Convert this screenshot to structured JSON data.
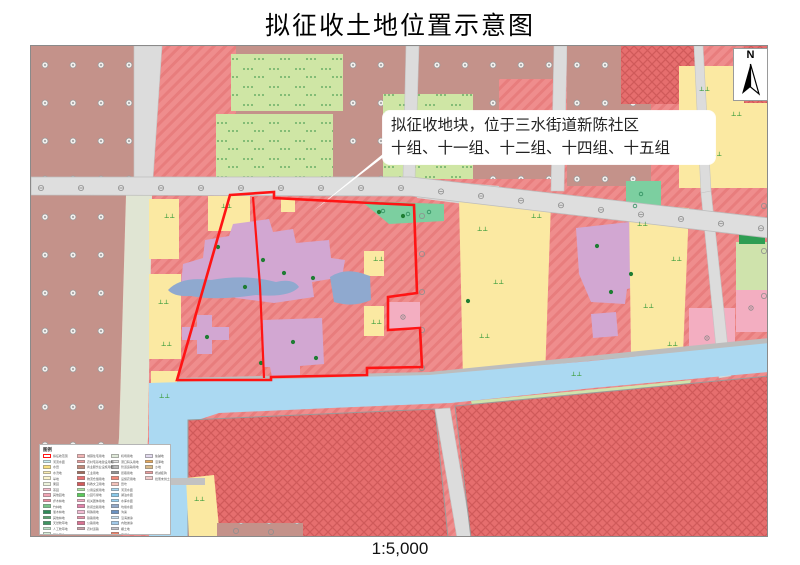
{
  "title": "拟征收土地位置示意图",
  "scale_label": "1:5,000",
  "north_label": "N",
  "annotation": {
    "line1": "拟征收地块，位于三水街道新陈社区",
    "line2": "十组、十一组、十二组、十四组、十五组"
  },
  "colors": {
    "boundary_red": "#ff1414",
    "hatch_base": "#ef8d8d",
    "hatch_line": "#e87d7d",
    "cross_base": "#e66e6e",
    "cross_line": "#d05a5a",
    "brown_parcel": "#c4928a",
    "paddy_green": "#cfe6a5",
    "yellow_parcel": "#fbe9a2",
    "lavender_parcel": "#d2a7d2",
    "pond_blue": "#8fa9cf",
    "canal_blue": "#abd9f2",
    "road_gray": "#dedede",
    "teal_parcel": "#7ccfa0",
    "pink_parcel": "#f3aec1",
    "pale_green": "#cfe3ac"
  },
  "legend": {
    "title": "图例",
    "columns": [
      [
        {
          "label": "拟征收范围",
          "color": "#ffffff",
          "type": "outline"
        },
        {
          "label": "河流水面",
          "color": "#c8eef0"
        },
        {
          "label": "水田",
          "color": "#f8df7e"
        },
        {
          "label": "水浇地",
          "color": "#fbedb0"
        },
        {
          "label": "旱地",
          "color": "#fdf5cd"
        },
        {
          "label": "果园",
          "color": "#eef3dc"
        },
        {
          "label": "茶园",
          "color": "#f6bcca"
        },
        {
          "label": "其他园地",
          "color": "#f2a6b6"
        },
        {
          "label": "乔木林地",
          "color": "#ec8c9e"
        },
        {
          "label": "竹林地",
          "color": "#78c488"
        },
        {
          "label": "灌木林地",
          "color": "#2e8b57"
        },
        {
          "label": "其他林地",
          "color": "#57a56d"
        },
        {
          "label": "天然牧草地",
          "color": "#3d9560"
        },
        {
          "label": "人工牧草地",
          "color": "#bce2c6"
        },
        {
          "label": "其他草地",
          "color": "#d6eed6"
        }
      ],
      [
        {
          "label": "城镇住宅用地",
          "color": "#f2b4b4"
        },
        {
          "label": "农村宅基地建设用地",
          "color": "#ea9c9c"
        },
        {
          "label": "商业服务业设施用地",
          "color": "#c28a7a"
        },
        {
          "label": "工业用地",
          "color": "#a26a5a"
        },
        {
          "label": "物流仓储用地",
          "color": "#ea7272"
        },
        {
          "label": "科教文卫用地",
          "color": "#d25a5a"
        },
        {
          "label": "公用设施用地",
          "color": "#aae2a2"
        },
        {
          "label": "公园与绿地",
          "color": "#5aca5a"
        },
        {
          "label": "机关团体用地",
          "color": "#f2aac2"
        },
        {
          "label": "新闻出版用地",
          "color": "#e282aa"
        },
        {
          "label": "特殊用地",
          "color": "#f2bad2"
        },
        {
          "label": "铁路用地",
          "color": "#ea92aa"
        },
        {
          "label": "公路用地",
          "color": "#da7292"
        },
        {
          "label": "农村道路",
          "color": "#caa2aa"
        }
      ],
      [
        {
          "label": "机场用地",
          "color": "#dfe9d9"
        },
        {
          "label": "港口码头用地",
          "color": "#e2e2e2"
        },
        {
          "label": "管道运输用地",
          "color": "#bababa"
        },
        {
          "label": "街巷用地",
          "color": "#929292"
        },
        {
          "label": "设施农用地",
          "color": "#f28a7a"
        },
        {
          "label": "田坎",
          "color": "#f2c2ba"
        },
        {
          "label": "河流水面",
          "color": "#aad8f2"
        },
        {
          "label": "湖泊水面",
          "color": "#8acaea"
        },
        {
          "label": "水库水面",
          "color": "#9ad2f2"
        },
        {
          "label": "坑塘水面",
          "color": "#92aaca"
        },
        {
          "label": "沟渠",
          "color": "#6a92c2"
        },
        {
          "label": "沿海滩涂",
          "color": "#cae2f2"
        },
        {
          "label": "内陆滩涂",
          "color": "#a2caea"
        },
        {
          "label": "裸土地",
          "color": "#c2c2ca"
        },
        {
          "label": "空闲地",
          "color": "#f28268"
        }
      ],
      [
        {
          "label": "盐碱地",
          "color": "#e2daee"
        },
        {
          "label": "沼泽地",
          "color": "#eaaa5a"
        },
        {
          "label": "沙地",
          "color": "#daba8a"
        },
        {
          "label": "增减挂钩",
          "color": "#eb9d9d"
        },
        {
          "label": "批而未供土地",
          "color": "#f2caca"
        }
      ]
    ]
  }
}
